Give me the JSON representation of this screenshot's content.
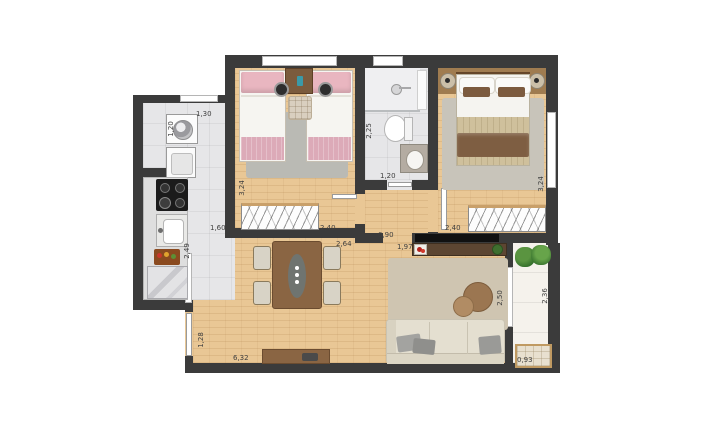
{
  "meta": {
    "type": "apartment-floor-plan",
    "style": "top-down furnished plan, dimensions in meters"
  },
  "colors": {
    "wall": "#3b3b3b",
    "wood_floor": "#e9c795",
    "tile_floor": "#e6e6e8",
    "balcony_floor": "#f5f2ec",
    "bed_pink": "#e9b6c0",
    "bed_blanket_brown": "#7e5e42",
    "rug_gray": "#babab4",
    "rug_beige": "#cfc5b1",
    "furniture_wood": "#8a6543",
    "tv_console_wood": "#5d4632",
    "sofa_beige": "#e4dfd0",
    "plant_green": "#3f7a2e",
    "label_text": "#3f3f3f"
  },
  "dimensions": {
    "service_width": "1,30",
    "service_depth": "1,20",
    "kitchen_length": "1,60",
    "kitchen_depth": "2,49",
    "bedroom1_depth": "3,24",
    "bedroom1_width": "2,40",
    "bathroom_depth": "2,25",
    "bathroom_width": "1,20",
    "bedroom2_width": "2,40",
    "bedroom2_depth": "3,24",
    "hall_opening": "0,90",
    "tv_wall": "1,97",
    "dining_span": "2,64",
    "living_length": "6,32",
    "entry_wall": "1,28",
    "balcony_opening": "2,50",
    "balcony_depth": "2,36",
    "balcony_bench": "0,93"
  }
}
